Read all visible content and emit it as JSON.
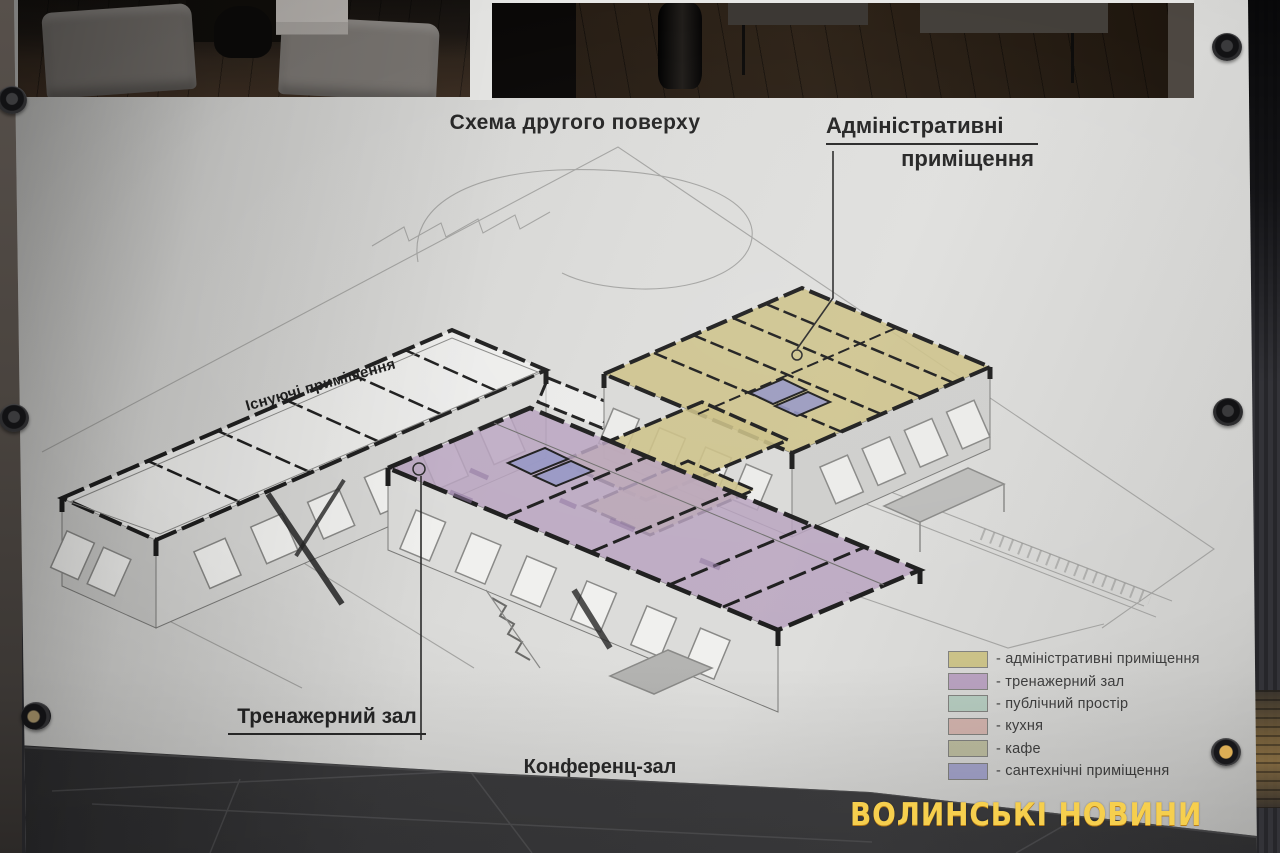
{
  "poster": {
    "title": "Схема другого поверху",
    "labels": {
      "admin_line1": "Адміністративні",
      "admin_line2": "приміщення",
      "existing": "Існуючі приміщення",
      "gym": "Тренажерний зал",
      "conference": "Конференц-зал"
    },
    "legend": [
      {
        "color": "#cbc288",
        "label": "- адміністративні приміщення"
      },
      {
        "color": "#b9a2c0",
        "label": "- тренажерний зал"
      },
      {
        "color": "#b5cbbf",
        "label": "- публічний простір"
      },
      {
        "color": "#d2b3ad",
        "label": "- кухня"
      },
      {
        "color": "#bcbc9f",
        "label": "- кафе"
      },
      {
        "color": "#a3a3ca",
        "label": "- сантехнічні приміщення"
      }
    ],
    "zone_colors": {
      "admin_fill": "rgba(205,194,135,0.88)",
      "gym_fill": "rgba(185,163,191,0.85)",
      "sanitary_fill": "rgba(150,151,197,0.9)"
    }
  },
  "watermark": {
    "text": "ВОЛИНСЬКІ НОВИНИ",
    "color": "#f6cf4e"
  }
}
